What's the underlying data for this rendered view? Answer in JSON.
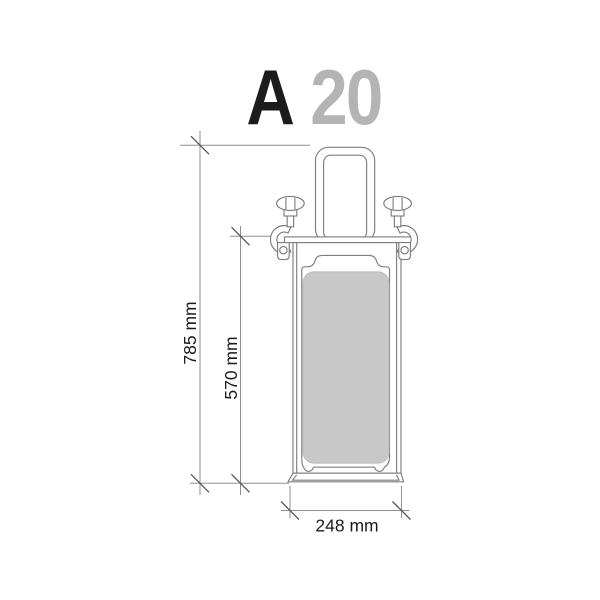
{
  "page": {
    "background": "#ffffff"
  },
  "title": {
    "series_letter": "A",
    "model_number": "20"
  },
  "dimensions": {
    "overall_height": "785 mm",
    "visible_height": "570 mm",
    "width": "248 mm"
  },
  "colors": {
    "title_letter": "#1c1c1c",
    "title_number": "#b4b4b4",
    "outline": "#7e7e7e",
    "dimension_line": "#8f8f8f",
    "tick": "#585858",
    "dimension_text": "#1a1a1a",
    "panel_fill": "#c8c8c8"
  }
}
